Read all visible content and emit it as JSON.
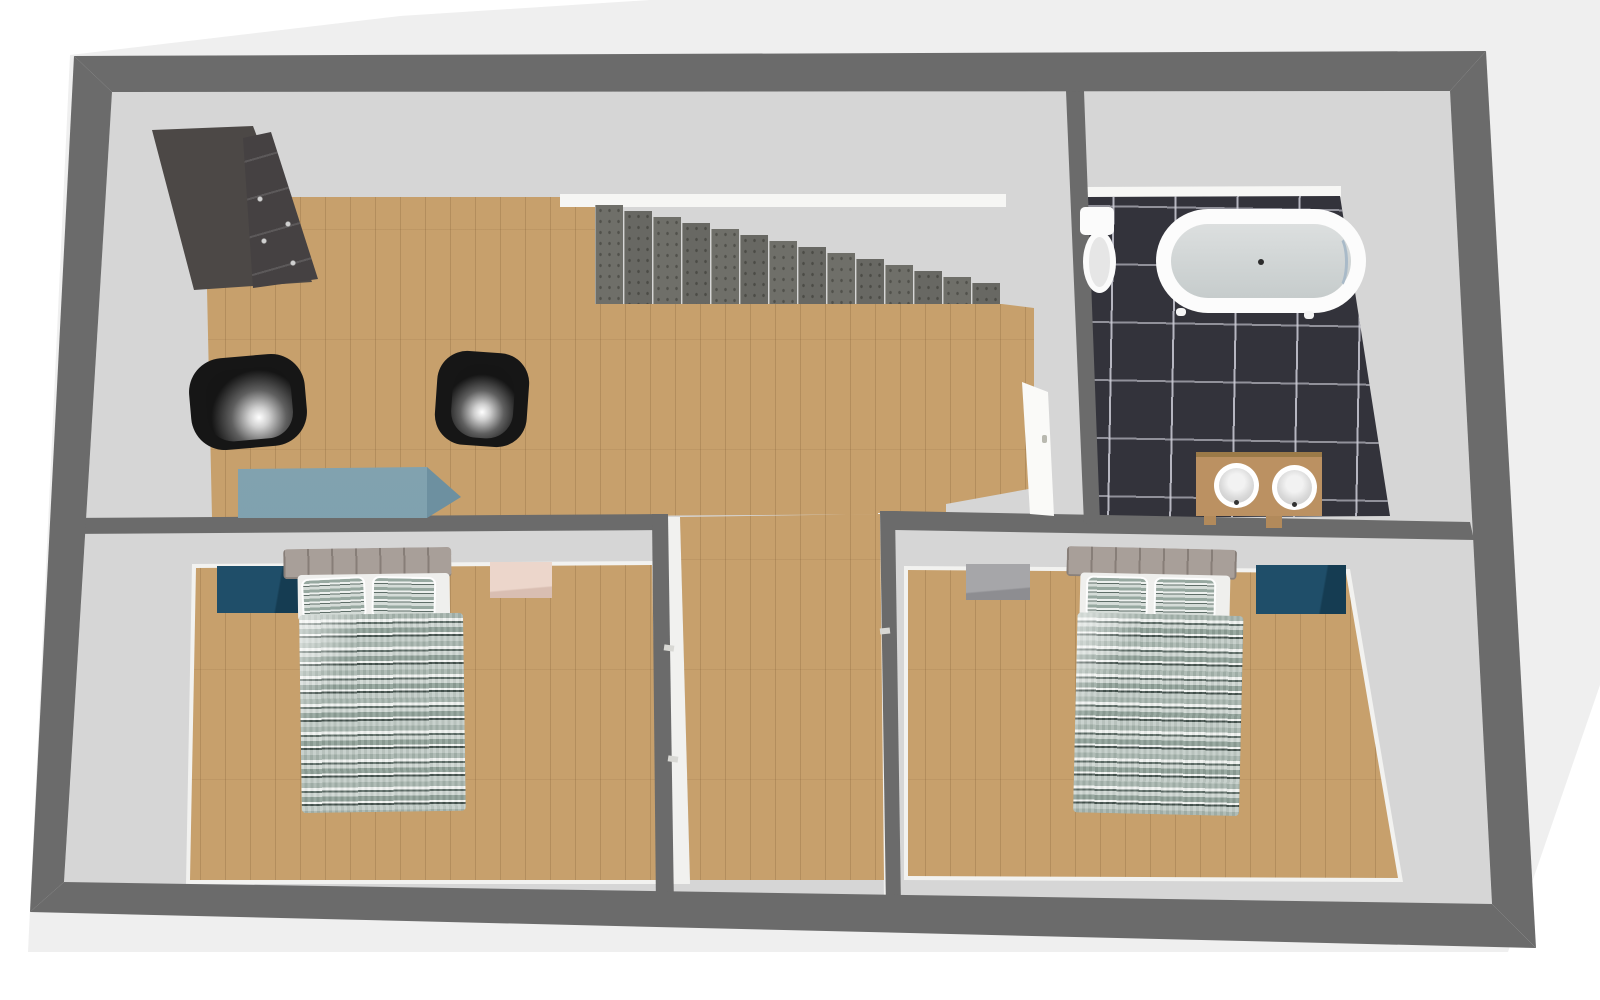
{
  "meta": {
    "view": "3d-floor-plan-top-view",
    "visible_text": []
  },
  "palette": {
    "background_white": "#ffffff",
    "background_gray": "#efefef",
    "wall_gray": "#6b6b6b",
    "inner_face_gray": "#d6d6d6",
    "wood_floor": "#c7a06c",
    "tile_dark": "#33333b",
    "tile_grout": "#c9c9d3",
    "wardrobe_dark": "#4c4846",
    "chair_black": "#161616",
    "desk_slate_blue": "#7b9dab",
    "nightstand_teal": "#1d4a63",
    "side_table_pink": "#e9d2c7",
    "side_table_gray": "#a2a2a5",
    "headboard_taupe": "#a89f99",
    "duvet_sage": "#9aaaa2",
    "duvet_dark_zigzag": "#46544f",
    "tub_white": "#fcfcfc",
    "tub_inner_gray": "#ced4d4",
    "vanity_wood": "#bb9162",
    "stair_gray": "#6f6f69"
  },
  "rooms": [
    {
      "name": "landing-hall",
      "floor": "wood",
      "contents": [
        "wardrobe",
        "armchair x2",
        "desk",
        "staircase"
      ]
    },
    {
      "name": "bathroom",
      "floor": "dark-tile",
      "contents": [
        "toilet",
        "freestanding-bathtub",
        "double-sink-vanity"
      ]
    },
    {
      "name": "bedroom-left",
      "floor": "wood",
      "contents": [
        "double-bed",
        "teal-nightstand",
        "pink-side-table"
      ]
    },
    {
      "name": "bedroom-right",
      "floor": "wood",
      "contents": [
        "double-bed",
        "teal-nightstand",
        "gray-side-table"
      ]
    },
    {
      "name": "corridor",
      "floor": "wood",
      "contents": []
    }
  ],
  "furniture": [
    {
      "name": "wardrobe",
      "room": "landing-hall",
      "color": "#4c4846"
    },
    {
      "name": "armchair-left",
      "room": "landing-hall",
      "color": "#161616"
    },
    {
      "name": "armchair-right",
      "room": "landing-hall",
      "color": "#161616"
    },
    {
      "name": "desk",
      "room": "landing-hall",
      "color": "#7b9dab"
    },
    {
      "name": "staircase",
      "room": "landing-hall",
      "steps": 14,
      "color": "#6f6f69"
    },
    {
      "name": "toilet",
      "room": "bathroom",
      "color": "#fbfbfb"
    },
    {
      "name": "bathtub",
      "room": "bathroom",
      "color": "#fcfcfc"
    },
    {
      "name": "vanity-two-sinks",
      "room": "bathroom",
      "color": "#bb9162"
    },
    {
      "name": "bed-left",
      "room": "bedroom-left",
      "bedding": "sage zigzag pattern"
    },
    {
      "name": "bed-right",
      "room": "bedroom-right",
      "bedding": "sage zigzag pattern"
    },
    {
      "name": "nightstand-left",
      "room": "bedroom-left",
      "color": "#1d4a63"
    },
    {
      "name": "nightstand-right",
      "room": "bedroom-right",
      "color": "#1d4a63"
    },
    {
      "name": "side-table-pink",
      "room": "bedroom-left",
      "color": "#e9d2c7"
    },
    {
      "name": "side-table-gray",
      "room": "bedroom-right",
      "color": "#a2a2a5"
    },
    {
      "name": "bathroom-door",
      "room": "bathroom",
      "state": "open",
      "color": "#fafaf8"
    }
  ]
}
